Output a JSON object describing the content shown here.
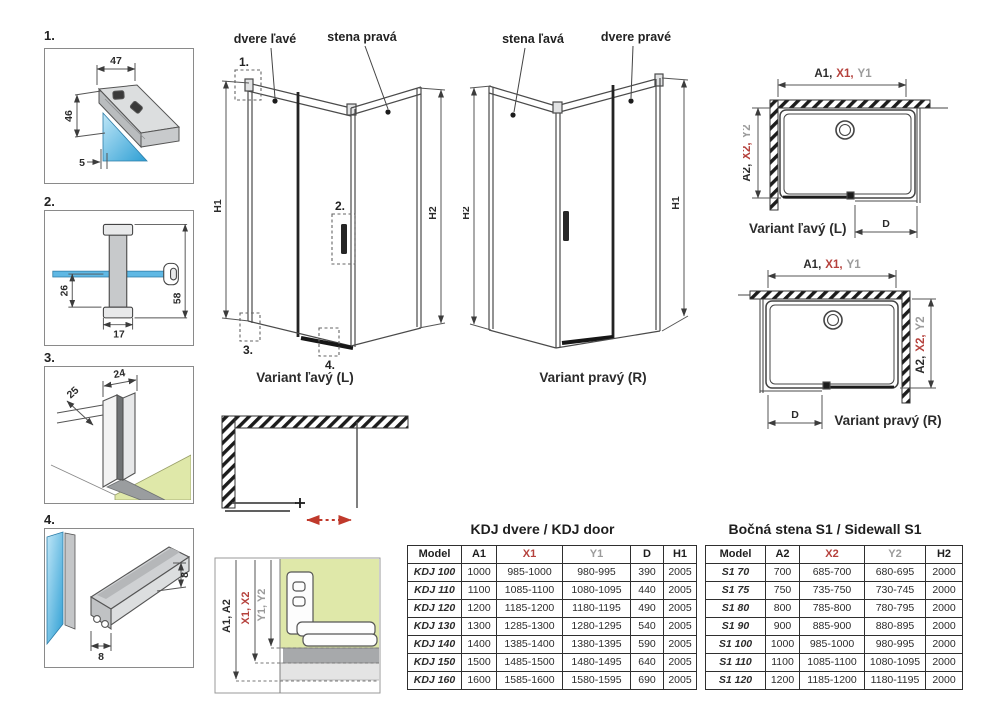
{
  "colors": {
    "accent_red": "#b5413c",
    "dim_gray": "#9b9b9b",
    "glass_blue": "#45aadd",
    "floor_green": "#dfe8a9"
  },
  "details": [
    {
      "num": "1.",
      "dims": {
        "top": "47",
        "side": "46",
        "glass": "5"
      }
    },
    {
      "num": "2.",
      "dims": {
        "inner": "26",
        "width": "17",
        "total": "58"
      }
    },
    {
      "num": "3.",
      "dims": {
        "depth": "25",
        "width": "24"
      }
    },
    {
      "num": "4.",
      "dims": {
        "height": "8",
        "width": "8"
      }
    }
  ],
  "elevation_left": {
    "label_door": "dvere ľavé",
    "label_wall": "stena pravá",
    "callout1": "1.",
    "callout2": "2.",
    "callout3": "3.",
    "callout4": "4.",
    "h_left": "H1",
    "h_right": "H2",
    "caption": "Variant ľavý (L)"
  },
  "elevation_right": {
    "label_wall": "stena ľavá",
    "label_door": "dvere pravé",
    "h_left": "H2",
    "h_right": "H1",
    "caption": "Variant pravý (R)"
  },
  "plan_left": {
    "dim_a": "A1,",
    "dim_x": "X1,",
    "dim_y": "Y1",
    "side_a": "A2,",
    "side_x": "X2,",
    "side_y": "Y2",
    "dim_d": "D",
    "caption": "Variant ľavý (L)"
  },
  "plan_right": {
    "dim_a": "A1,",
    "dim_x": "X1,",
    "dim_y": "Y1",
    "side_a": "A2,",
    "side_x": "X2,",
    "side_y": "Y2",
    "dim_d": "D",
    "caption": "Variant pravý (R)"
  },
  "section": {
    "label_a": "A1, A2",
    "label_x": "X1, X2",
    "label_y": "Y1, Y2"
  },
  "tables": {
    "kdj": {
      "title": "KDJ dvere / KDJ door",
      "headers": [
        {
          "label": "Model",
          "tone": "dark"
        },
        {
          "label": "A1",
          "tone": "dark"
        },
        {
          "label": "X1",
          "tone": "red"
        },
        {
          "label": "Y1",
          "tone": "gray"
        },
        {
          "label": "D",
          "tone": "dark"
        },
        {
          "label": "H1",
          "tone": "dark"
        }
      ],
      "rows": [
        [
          "KDJ 100",
          "1000",
          "985-1000",
          "980-995",
          "390",
          "2005"
        ],
        [
          "KDJ 110",
          "1100",
          "1085-1100",
          "1080-1095",
          "440",
          "2005"
        ],
        [
          "KDJ 120",
          "1200",
          "1185-1200",
          "1180-1195",
          "490",
          "2005"
        ],
        [
          "KDJ 130",
          "1300",
          "1285-1300",
          "1280-1295",
          "540",
          "2005"
        ],
        [
          "KDJ 140",
          "1400",
          "1385-1400",
          "1380-1395",
          "590",
          "2005"
        ],
        [
          "KDJ 150",
          "1500",
          "1485-1500",
          "1480-1495",
          "640",
          "2005"
        ],
        [
          "KDJ 160",
          "1600",
          "1585-1600",
          "1580-1595",
          "690",
          "2005"
        ]
      ]
    },
    "s1": {
      "title": "Bočná stena S1 / Sidewall S1",
      "headers": [
        {
          "label": "Model",
          "tone": "dark"
        },
        {
          "label": "A2",
          "tone": "dark"
        },
        {
          "label": "X2",
          "tone": "red"
        },
        {
          "label": "Y2",
          "tone": "gray"
        },
        {
          "label": "H2",
          "tone": "dark"
        }
      ],
      "rows": [
        [
          "S1 70",
          "700",
          "685-700",
          "680-695",
          "2000"
        ],
        [
          "S1 75",
          "750",
          "735-750",
          "730-745",
          "2000"
        ],
        [
          "S1 80",
          "800",
          "785-800",
          "780-795",
          "2000"
        ],
        [
          "S1 90",
          "900",
          "885-900",
          "880-895",
          "2000"
        ],
        [
          "S1 100",
          "1000",
          "985-1000",
          "980-995",
          "2000"
        ],
        [
          "S1 110",
          "1100",
          "1085-1100",
          "1080-1095",
          "2000"
        ],
        [
          "S1 120",
          "1200",
          "1185-1200",
          "1180-1195",
          "2000"
        ]
      ]
    }
  }
}
